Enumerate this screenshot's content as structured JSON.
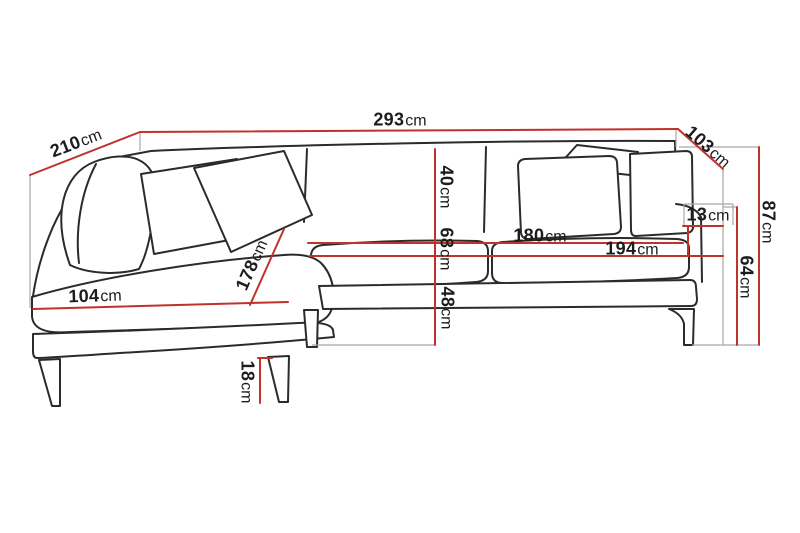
{
  "diagram": {
    "subject": "corner-sofa-dimension-drawing",
    "colors": {
      "dimension_line": "#c0322c",
      "outline": "#2b2b2b",
      "projection_line": "#a6a6a6",
      "background": "#ffffff"
    },
    "measurements": {
      "overall_width": {
        "value": "293",
        "unit": "cm"
      },
      "chaise_side_depth": {
        "value": "210",
        "unit": "cm"
      },
      "right_side_depth": {
        "value": "103",
        "unit": "cm"
      },
      "overall_height": {
        "value": "87",
        "unit": "cm"
      },
      "armrest_height": {
        "value": "64",
        "unit": "cm"
      },
      "armrest_above_seat": {
        "value": "13",
        "unit": "cm"
      },
      "seat_width_to_armrest": {
        "value": "194",
        "unit": "cm"
      },
      "seat_width_between": {
        "value": "180",
        "unit": "cm"
      },
      "back_cushion_height": {
        "value": "40",
        "unit": "cm"
      },
      "back_height_above_seat": {
        "value": "68",
        "unit": "cm"
      },
      "seat_height": {
        "value": "48",
        "unit": "cm"
      },
      "chaise_length": {
        "value": "178",
        "unit": "cm"
      },
      "chaise_front_width": {
        "value": "104",
        "unit": "cm"
      },
      "leg_height": {
        "value": "18",
        "unit": "cm"
      }
    }
  }
}
